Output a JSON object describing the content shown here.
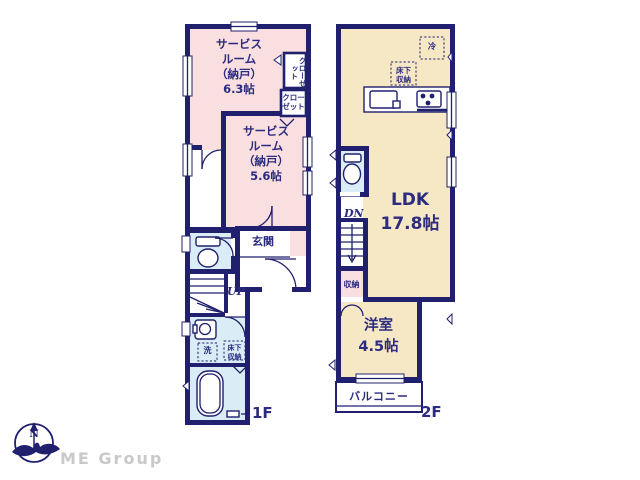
{
  "palette": {
    "wall": "#20206e",
    "text": "#2b2b80",
    "room_pink": "#f9dfdf",
    "room_cream": "#f7e8c5",
    "room_blue": "#daecf5",
    "logo_gray": "#c9c9c9"
  },
  "floor1": {
    "floor_label": "1F",
    "service_room_1": "サービス\nルーム\n（納戸）\n6.3帖",
    "closet_vertical": "クローゼット",
    "closet": "クロー\nゼット",
    "service_room_2": "サービス\nルーム\n（納戸）\n5.6帖",
    "entrance": "玄関",
    "stairs_up": "UP",
    "laundry": "洗",
    "underfloor_storage": "床下\n収納"
  },
  "floor2": {
    "floor_label": "2F",
    "refrigerator": "冷",
    "underfloor_storage": "床下\n収納",
    "ldk": "LDK\n17.8帖",
    "stairs_down": "DN",
    "storage": "収納",
    "western_room": "洋室\n4.5帖",
    "balcony": "バルコニー"
  },
  "logo": {
    "compass_north": "N",
    "company": "ME Group"
  }
}
